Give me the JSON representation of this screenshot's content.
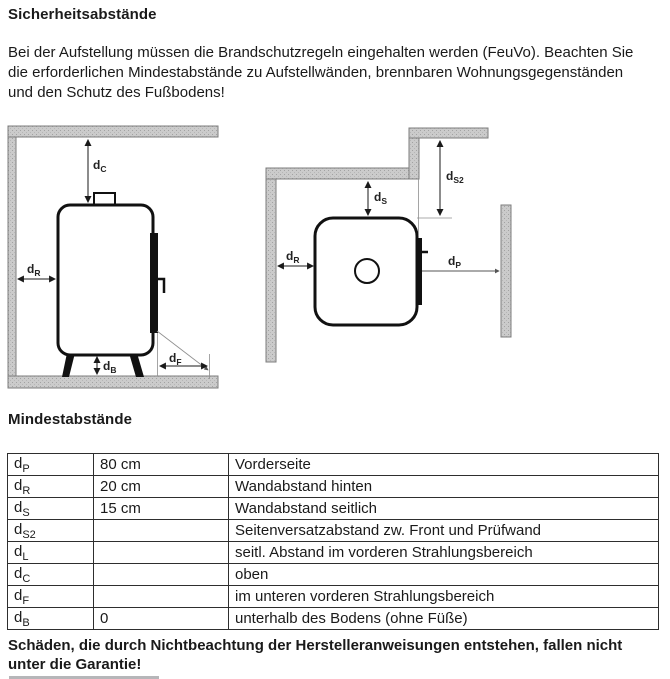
{
  "page": {
    "title": "Sicherheitsabstände",
    "intro": "Bei der Aufstellung müssen die Brandschutzregeln eingehalten werden (FeuVo). Beachten Sie die erforderlichen Mindestabstände zu Aufstellwänden, brennbaren Wohnungsgegenständen und den Schutz des Fußbodens!",
    "section2_title": "Mindestabstände",
    "footer_warning": "Schäden, die durch Nichtbeachtung der Herstelleranweisungen entstehen, fallen nicht unter die Garantie!"
  },
  "diagrams": {
    "side_view": {
      "labels": {
        "dC": {
          "base": "d",
          "sub": "C"
        },
        "dR": {
          "base": "d",
          "sub": "R"
        },
        "dB": {
          "base": "d",
          "sub": "B"
        },
        "dF": {
          "base": "d",
          "sub": "F"
        }
      }
    },
    "top_view": {
      "labels": {
        "dS": {
          "base": "d",
          "sub": "S"
        },
        "dS2": {
          "base": "d",
          "sub": "S2"
        },
        "dR": {
          "base": "d",
          "sub": "R"
        },
        "dP": {
          "base": "d",
          "sub": "P"
        }
      }
    }
  },
  "table": {
    "rows": [
      {
        "label": {
          "base": "d",
          "sub": "P"
        },
        "value": "80 cm",
        "description": "Vorderseite"
      },
      {
        "label": {
          "base": "d",
          "sub": "R"
        },
        "value": "20 cm",
        "description": "Wandabstand hinten"
      },
      {
        "label": {
          "base": "d",
          "sub": "S"
        },
        "value": "15 cm",
        "description": "Wandabstand seitlich"
      },
      {
        "label": {
          "base": "d",
          "sub": "S2"
        },
        "value": "",
        "description": "Seitenversatzabstand zw. Front und Prüfwand"
      },
      {
        "label": {
          "base": "d",
          "sub": "L"
        },
        "value": "",
        "description": "seitl. Abstand im vorderen Strahlungsbereich"
      },
      {
        "label": {
          "base": "d",
          "sub": "C"
        },
        "value": "",
        "description": "oben"
      },
      {
        "label": {
          "base": "d",
          "sub": "F"
        },
        "value": "",
        "description": "im unteren vorderen Strahlungsbereich"
      },
      {
        "label": {
          "base": "d",
          "sub": "B"
        },
        "value": "0",
        "description": "unterhalb des Bodens (ohne Füße)"
      }
    ]
  },
  "colors": {
    "wall_fill": "#cbcbcb",
    "wall_stroke": "#7c7c7c",
    "line": "#1a1a1a",
    "thin_line": "#8f8f8f"
  }
}
